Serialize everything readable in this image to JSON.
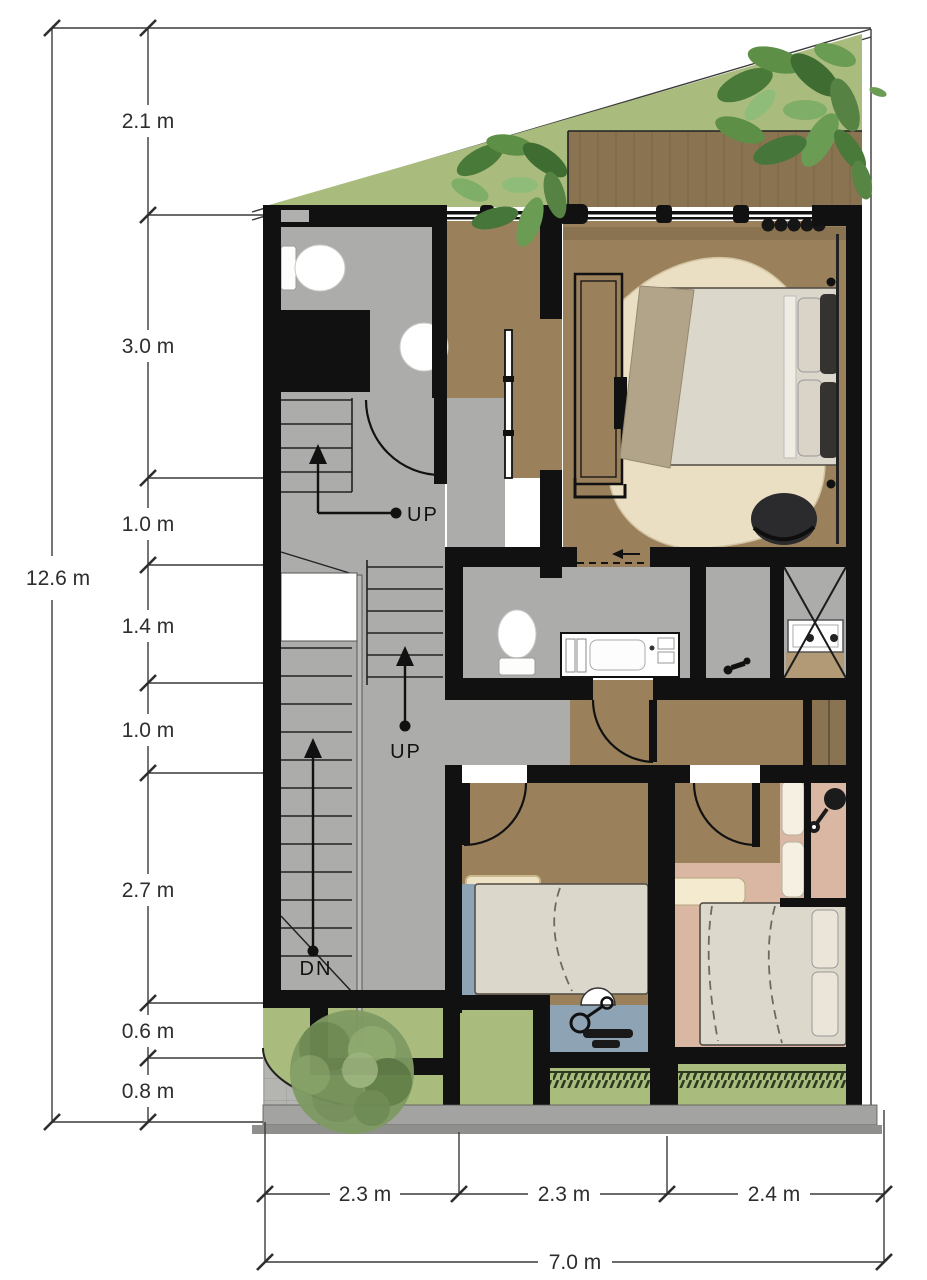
{
  "drawing": {
    "type": "floor-plan",
    "stairs": {
      "up_first": "UP",
      "up_second": "UP",
      "down": "DN"
    },
    "dimensions": {
      "left": {
        "total": "12.6 m",
        "segments": [
          "2.1 m",
          "3.0 m",
          "1.0 m",
          "1.4 m",
          "1.0 m",
          "2.7 m",
          "0.6 m",
          "0.8 m"
        ]
      },
      "bottom": {
        "total": "7.0 m",
        "segments": [
          "2.3 m",
          "2.3 m",
          "2.4 m"
        ]
      }
    },
    "colors": {
      "wall": "#111111",
      "wood_floor": "#9a815c",
      "wood_dark": "#8a7351",
      "gray_floor": "#acacaa",
      "grass": "#a9bc7e",
      "blue_floor": "#8ea4b5",
      "pink_floor": "#d9b7a2",
      "rug": "#eadfc3",
      "bed_linen": "#dcd7cb",
      "pavement": "#a3a3a1",
      "hedge_dark": "#2c3a1e",
      "dim_line": "#3a3a3a"
    }
  }
}
